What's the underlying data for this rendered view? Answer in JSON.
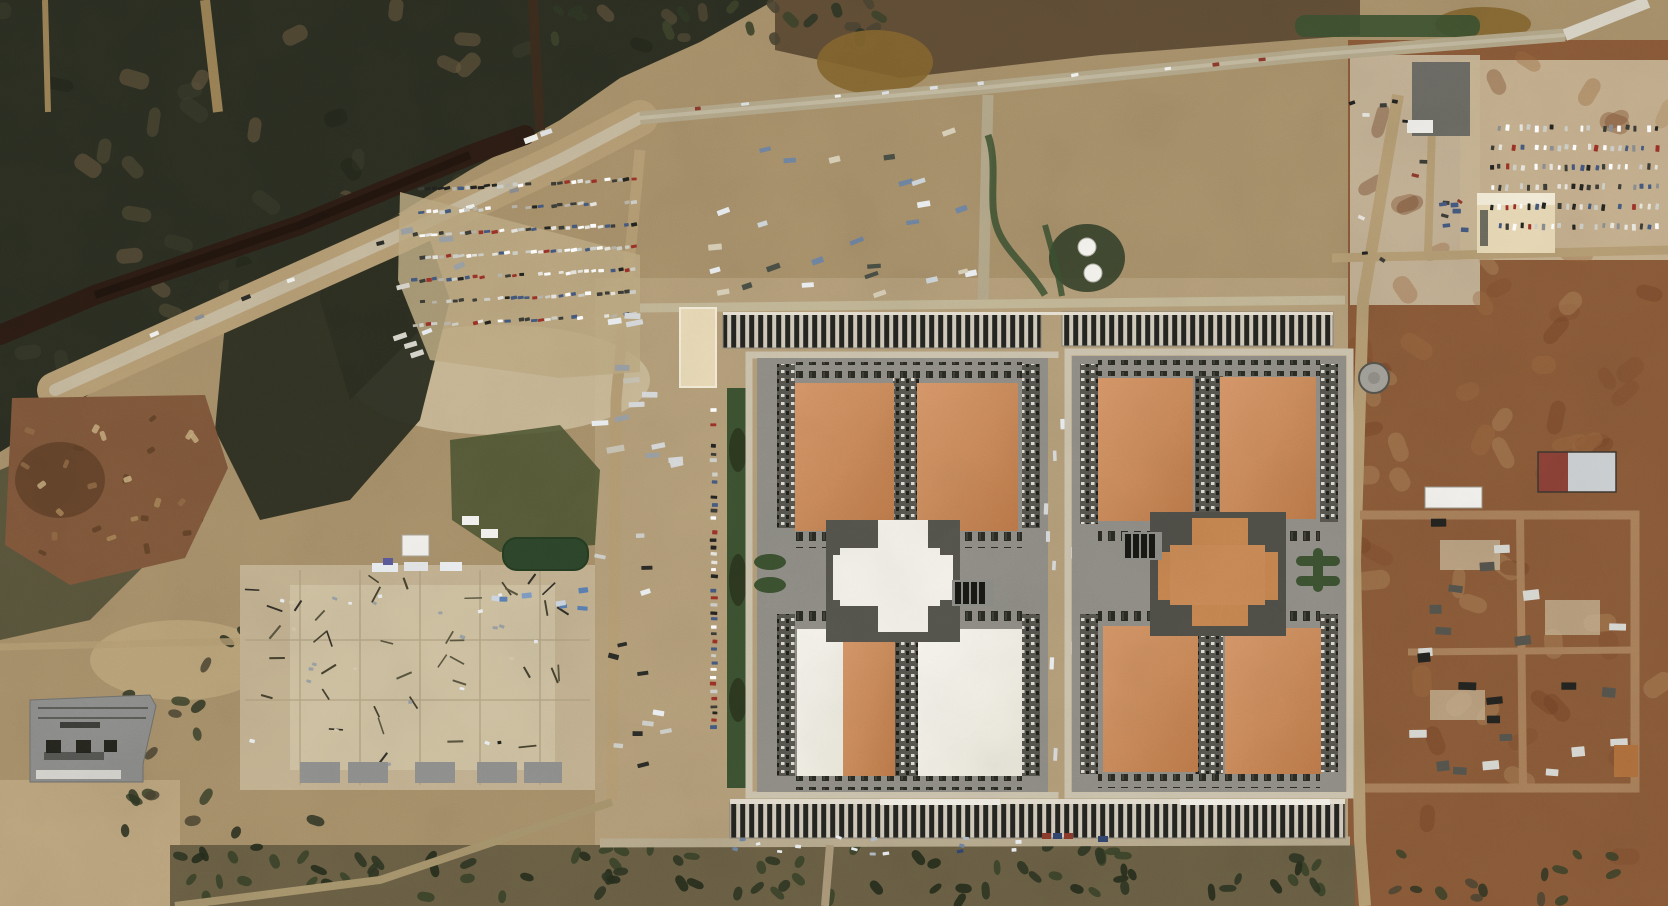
{
  "meta": {
    "alt": "Satellite aerial view of a large data center campus under construction: eight orange-roofed server halls arranged around two cross-shaped central hubs, long rows of dark equipment arrays on the north and south edges, dirt parking lots full of vehicles, laydown yards, an electrical substation, scrubland with a creek at upper left, and red-dirt power-plant construction zones on the right.",
    "width": 1668,
    "height": 906
  },
  "palette": {
    "base_dirt": "#a7906a",
    "dirt_light": "#c7b491",
    "dirt_pale": "#d6c9ab",
    "road_tan": "#b59d74",
    "road_light": "#c9c0a9",
    "road_gray": "#b3a789",
    "road_white": "#d9d4c6",
    "scrub_dark": "#2b2e21",
    "scrub_mid": "#46462f",
    "scrub_brown": "#60513a",
    "creek": "#2c1c13",
    "mud_dark": "#5c4a33",
    "pond_mud": "#84652e",
    "veg_green": "#3b5130",
    "pond_green": "#2d452b",
    "pad_gray": "#8f8d86",
    "dock_gray": "#57564e",
    "unit_dark": "#26261f",
    "stripe_bg": "#d2cbbc",
    "stripe_bar": "#242420",
    "roof_orange": "#ca8a5a",
    "roof_orange_hi": "#d69668",
    "roof_orange_lo": "#bb7747",
    "roof_white": "#f3f1ea",
    "cream": "#e9dab6",
    "concrete": "#8f8f8d",
    "red_zone": "#8a5a38",
    "red_zone_dark": "#6f3f24",
    "steel_blue": "#6f84a0",
    "container_red": "#8c3a2b",
    "container_blue": "#31456f",
    "white": "#f6f5f1",
    "black": "#1c1c18"
  },
  "scatter": [
    {
      "name": "scrub-mottle",
      "target": "nw_scrub_mottle",
      "type": "uniform",
      "area": [
        0,
        0,
        760,
        455
      ],
      "count": 70,
      "item": [
        26,
        14
      ],
      "rx": 7,
      "opacity": 0.55,
      "angleJitter": 180,
      "colors": [
        "#20241a",
        "#3a3d2b",
        "#555038",
        "#6b5b41"
      ],
      "seed": 61
    },
    {
      "name": "hedge-bush",
      "target": "top_hedge",
      "type": "uniform",
      "area": [
        555,
        0,
        345,
        42
      ],
      "count": 22,
      "item": [
        16,
        9
      ],
      "rx": 5,
      "opacity": 0.9,
      "angleJitter": 180,
      "colors": [
        "#2e3523",
        "#3c4229",
        "#4a4431"
      ],
      "seed": 7
    },
    {
      "name": "red-dirt-mottle",
      "target": "rz_mottle",
      "type": "uniform",
      "area": [
        1350,
        60,
        318,
        800
      ],
      "count": 70,
      "item": [
        30,
        16
      ],
      "rx": 9,
      "opacity": 0.4,
      "angleJitter": 180,
      "colors": [
        "#6f3f24",
        "#9a6a42",
        "#7d4a2c",
        "#b08a5f"
      ],
      "seed": 67
    },
    {
      "name": "parked-car",
      "target": "left_lot",
      "type": "rows",
      "area": [
        415,
        190,
        225,
        158
      ],
      "rows": 7,
      "perRow": 34,
      "slope": -0.05,
      "skip": 0.15,
      "item": [
        5.5,
        3.2
      ],
      "angle": -8,
      "angleJitter": 6,
      "colors": [
        "#ffffff",
        "#e8e6df",
        "#cfd0c9",
        "#3c3c37",
        "#23231f",
        "#9c3127",
        "#44597f",
        "#b9b4a8"
      ],
      "seed": 11
    },
    {
      "name": "parked-truck",
      "target": "lot_edge_trucks",
      "type": "uniform",
      "area": [
        400,
        230,
        60,
        140
      ],
      "count": 8,
      "item": [
        12,
        5
      ],
      "angle": -10,
      "angleJitter": 14,
      "colors": [
        "#eceff1",
        "#d8d5cc",
        "#9aa0a4"
      ],
      "seed": 21
    },
    {
      "name": "parked-car",
      "target": "west_col_cars",
      "type": "rows",
      "area": [
        714,
        403,
        10,
        332
      ],
      "rows": 46,
      "perRow": 1,
      "skip": 0.12,
      "item": [
        6,
        3.4
      ],
      "angle": 2,
      "angleJitter": 4,
      "colors": [
        "#ffffff",
        "#e8e6df",
        "#3c3c37",
        "#23231f",
        "#9c3127",
        "#44597f",
        "#cfd0c9"
      ],
      "seed": 3
    },
    {
      "name": "trailer",
      "target": "campus_w_trailers",
      "type": "uniform",
      "area": [
        600,
        285,
        95,
        210
      ],
      "count": 15,
      "item": [
        15,
        5.5
      ],
      "angle": -6,
      "angleJitter": 8,
      "colors": [
        "#eceff1",
        "#d8dadb",
        "#9aa0a4",
        "#c9c4b4"
      ],
      "seed": 5
    },
    {
      "name": "truck",
      "target": "campus_w_trucks",
      "type": "uniform",
      "area": [
        600,
        505,
        95,
        280
      ],
      "count": 13,
      "item": [
        10,
        4.5
      ],
      "angleJitter": 20,
      "colors": [
        "#eceff1",
        "#2b2b27",
        "#cfd0c9"
      ],
      "seed": 9
    },
    {
      "name": "trailer",
      "target": "top_trailers",
      "type": "uniform",
      "area": [
        715,
        130,
        260,
        165
      ],
      "count": 26,
      "item": [
        12,
        5
      ],
      "angle": -14,
      "angleJitter": 10,
      "colors": [
        "#eceff1",
        "#cfd6da",
        "#6f84a0",
        "#4a4f45",
        "#d9d0b8"
      ],
      "seed": 13
    },
    {
      "name": "road-vehicle",
      "target": "road_vehicles",
      "type": "rows",
      "area": [
        650,
        112,
        660,
        6
      ],
      "rows": 1,
      "perRow": 14,
      "slope": -0.085,
      "skip": 0.2,
      "item": [
        7,
        3.4
      ],
      "angle": -7,
      "angleJitter": 4,
      "colors": [
        "#f2f2ef",
        "#2b2b27",
        "#8c3a2b",
        "#dfe2e4"
      ],
      "seed": 17
    },
    {
      "name": "parked-car",
      "target": "tr_lot",
      "type": "rows",
      "area": [
        1492,
        128,
        172,
        118
      ],
      "rows": 6,
      "perRow": 23,
      "skip": 0.18,
      "item": [
        3.4,
        5.6
      ],
      "angle": 4,
      "angleJitter": 6,
      "colors": [
        "#ffffff",
        "#e8e6df",
        "#cfd0c9",
        "#3c3c37",
        "#23231f",
        "#9c3127",
        "#44597f",
        "#8a8d90"
      ],
      "seed": 19
    },
    {
      "name": "parked-car",
      "target": "tr_scatter_dark",
      "type": "uniform",
      "area": [
        1352,
        98,
        115,
        195
      ],
      "count": 13,
      "item": [
        6.5,
        3.5
      ],
      "angleJitter": 40,
      "colors": [
        "#23231f",
        "#3c3c37",
        "#8c3a2b",
        "#e8e6df"
      ],
      "seed": 23
    },
    {
      "name": "generator-unit",
      "target": "rz_units",
      "type": "uniform",
      "area": [
        1418,
        522,
        210,
        260
      ],
      "count": 24,
      "item": [
        15,
        8.5
      ],
      "angleJitter": 8,
      "colors": [
        "#23231f",
        "#d9d9d4",
        "#55544c"
      ],
      "seed": 29
    },
    {
      "name": "steel-framing",
      "target": "pad_steel",
      "type": "uniform",
      "area": [
        252,
        575,
        335,
        190
      ],
      "count": 38,
      "item": [
        15,
        1.8
      ],
      "angleJitter": 90,
      "colors": [
        "#46422f",
        "#5a5540",
        "#33302a"
      ],
      "seed": 31
    },
    {
      "name": "pad-equipment",
      "target": "pad_specks",
      "type": "uniform",
      "area": [
        252,
        572,
        335,
        195
      ],
      "count": 26,
      "item": [
        4.5,
        3
      ],
      "angleJitter": 30,
      "colors": [
        "#eceff1",
        "#9aa0a4",
        "#23231f",
        "#d6c9ab"
      ],
      "seed": 37
    },
    {
      "name": "blue-material-stack",
      "target": "blue_stacks",
      "type": "uniform",
      "area": [
        497,
        590,
        92,
        22
      ],
      "count": 7,
      "item": [
        9,
        4.5
      ],
      "angleJitter": 10,
      "colors": [
        "#5a7fb3",
        "#7e9cc4",
        "#cfd8e4"
      ],
      "seed": 41
    },
    {
      "name": "pallet",
      "target": "bottom_debris",
      "type": "uniform",
      "area": [
        735,
        836,
        310,
        20
      ],
      "count": 16,
      "item": [
        5.5,
        3.2
      ],
      "angleJitter": 20,
      "colors": [
        "#eceff1",
        "#6f84a0",
        "#b3bcc6",
        "#31456f"
      ],
      "seed": 43
    },
    {
      "name": "vegetation",
      "target": "veg_bottom",
      "type": "uniform",
      "area": [
        180,
        846,
        1165,
        56
      ],
      "count": 85,
      "item": [
        15,
        8
      ],
      "rx": 6,
      "opacity": 0.9,
      "angleJitter": 180,
      "colors": [
        "#2e3522",
        "#3a4229",
        "#262c1c"
      ],
      "seed": 47
    },
    {
      "name": "vegetation",
      "target": "veg_sw",
      "type": "uniform",
      "area": [
        125,
        612,
        225,
        225
      ],
      "count": 24,
      "item": [
        16,
        9
      ],
      "rx": 7,
      "opacity": 0.85,
      "angleJitter": 180,
      "colors": [
        "#2e3522",
        "#3a4229",
        "#262c1c",
        "#4a4431"
      ],
      "seed": 53
    },
    {
      "name": "vegetation",
      "target": "veg_right_bottom",
      "type": "uniform",
      "area": [
        1395,
        852,
        235,
        50
      ],
      "count": 14,
      "item": [
        14,
        8
      ],
      "rx": 6,
      "opacity": 0.85,
      "angleJitter": 180,
      "colors": [
        "#2e3522",
        "#3a4229",
        "#4a4431"
      ],
      "seed": 59
    },
    {
      "name": "dock-truck",
      "target": "dock_trucks_L",
      "type": "uniform",
      "area": [
        1046,
        380,
        26,
        380
      ],
      "count": 9,
      "item": [
        4,
        11
      ],
      "angleJitter": 4,
      "colors": [
        "#eceff1",
        "#d8dadb"
      ],
      "seed": 71
    },
    {
      "name": "haul-vehicle",
      "target": "corridor_vehicles",
      "type": "rows",
      "area": [
        110,
        352,
        450,
        8
      ],
      "rows": 1,
      "perRow": 10,
      "slope": -0.4,
      "skip": 0.25,
      "item": [
        8,
        3.6
      ],
      "angle": -22,
      "angleJitter": 8,
      "colors": [
        "#2b2b27",
        "#f2f2ef",
        "#8a8d90"
      ],
      "seed": 73
    },
    {
      "name": "trailer",
      "target": "rz_top_trailers",
      "type": "uniform",
      "area": [
        1443,
        198,
        22,
        48
      ],
      "count": 5,
      "item": [
        9,
        4
      ],
      "angleJitter": 8,
      "colors": [
        "#eceff1",
        "#44597f"
      ],
      "seed": 77
    },
    {
      "name": "rock-spoil",
      "target": "quarry_rocks",
      "type": "uniform",
      "area": [
        25,
        405,
        185,
        155
      ],
      "count": 26,
      "item": [
        9,
        5
      ],
      "rx": 2,
      "opacity": 0.85,
      "angleJitter": 180,
      "colors": [
        "#a78458",
        "#8f6a45",
        "#5f4026",
        "#c7ab7f"
      ],
      "seed": 79
    }
  ]
}
